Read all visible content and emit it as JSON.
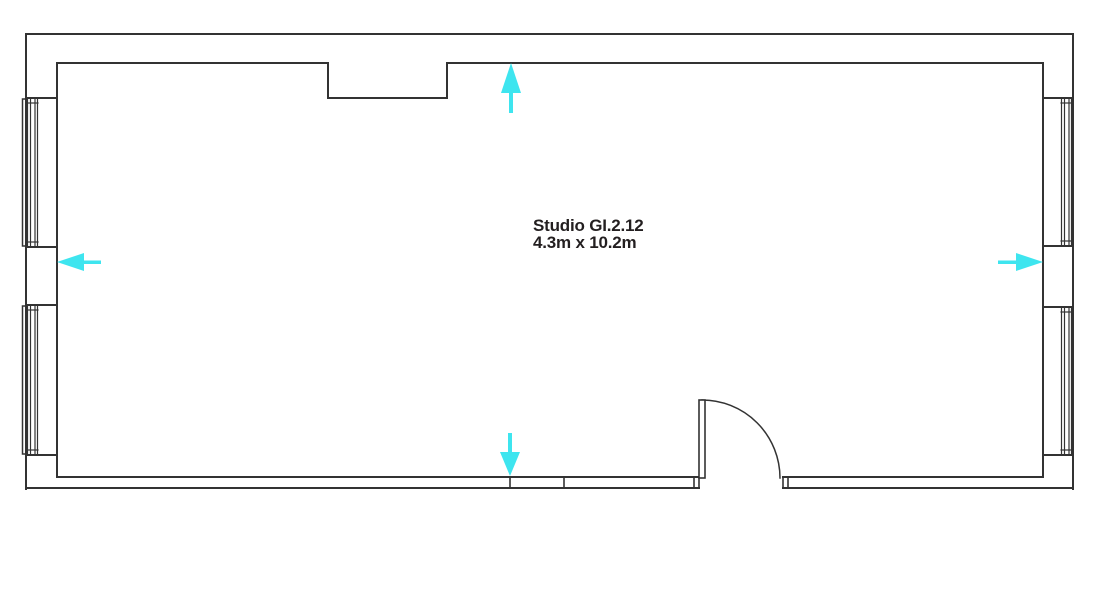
{
  "room": {
    "label": "Studio GI.2.12",
    "dimensions": "4.3m x 10.2m"
  },
  "colors": {
    "wall_line": "#333333",
    "accent_cyan": "#3ee5ef",
    "text": "#231f20",
    "background": "#ffffff"
  },
  "features": {
    "windows_left_wall": 2,
    "windows_right_wall": 2,
    "door": "bottom wall, right of center, quarter-circle swing into room",
    "wall_recess": "top wall, left of center",
    "arrows": [
      {
        "position": "top-center",
        "direction": "up"
      },
      {
        "position": "bottom-center",
        "direction": "down"
      },
      {
        "position": "left-middle",
        "direction": "left"
      },
      {
        "position": "right-middle",
        "direction": "right"
      }
    ]
  }
}
